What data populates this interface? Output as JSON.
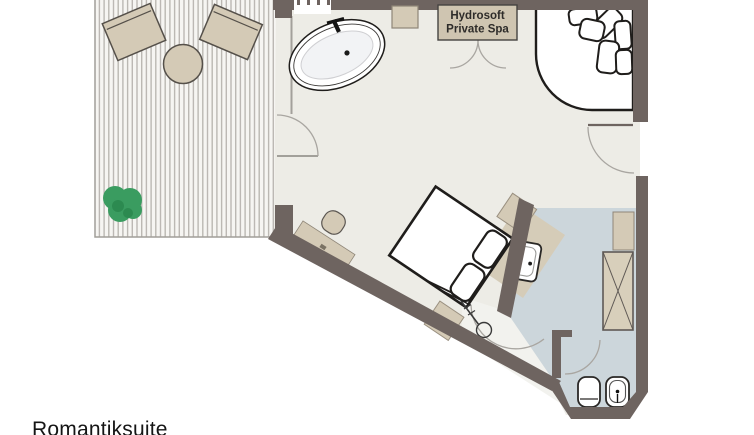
{
  "title": "Romantiksuite",
  "spa_cabin": {
    "label_line1": "Hydrosoft",
    "label_line2": "Private Spa"
  },
  "colors": {
    "wall": "#6e6460",
    "floor": "#edece6",
    "bathroom_floor": "#ccd6db",
    "shower_floor": "#f2f2ee",
    "terrace_base": "#f6f5f2",
    "terrace_stripe": "#bbb8b3",
    "furniture_beige": "#d4cab6",
    "counter_beige": "#d5ccb8",
    "spa_box_beige": "#cfc5b1",
    "wardrobe_beige": "#d8cfbb",
    "plant_green": "#3a9c60",
    "plant_green_dark": "#2c8a50",
    "fixture_white": "#ffffff",
    "outline_dark": "#1f1d1b",
    "door_arc_gray": "#a9a6a1",
    "title_color": "#151515"
  }
}
